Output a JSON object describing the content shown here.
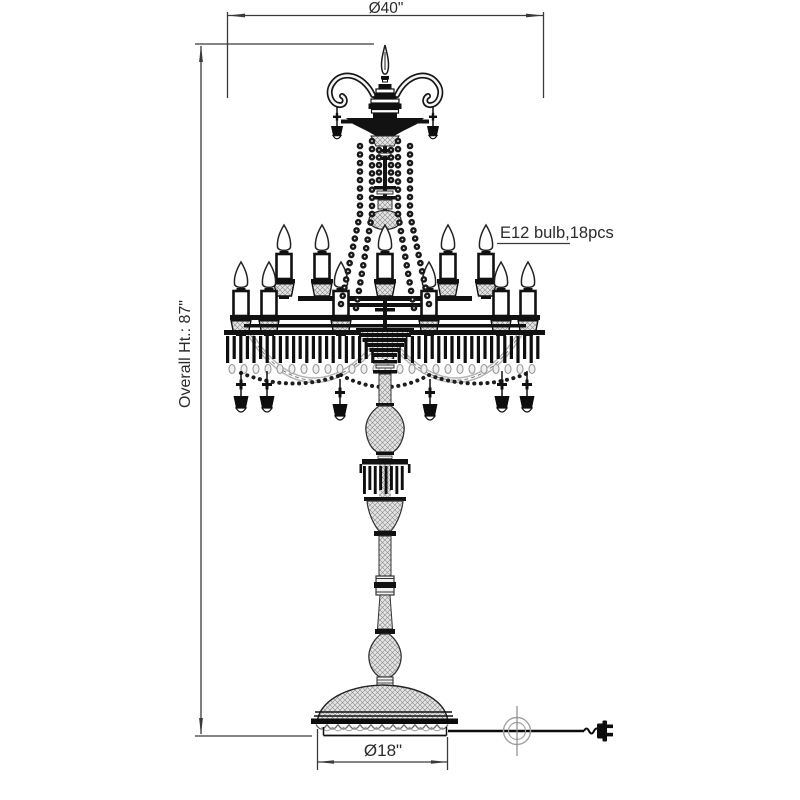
{
  "drawing": {
    "kind": "technical line drawing",
    "annotations": {
      "top_diameter_label": "Ø40\"",
      "overall_height_label": "Overall Ht.: 87\"",
      "bulb_label": "E12 bulb,18pcs",
      "base_diameter_label": "Ø18\""
    },
    "values": {
      "top_diameter_in": 40,
      "overall_height_in": 87,
      "base_diameter_in": 18,
      "bulb_type": "E12",
      "bulb_count": 18
    },
    "colors": {
      "background": "#ffffff",
      "line": "#111111",
      "dimension": "#3a3a3a",
      "glass_fill": "#e4e4e4"
    }
  }
}
